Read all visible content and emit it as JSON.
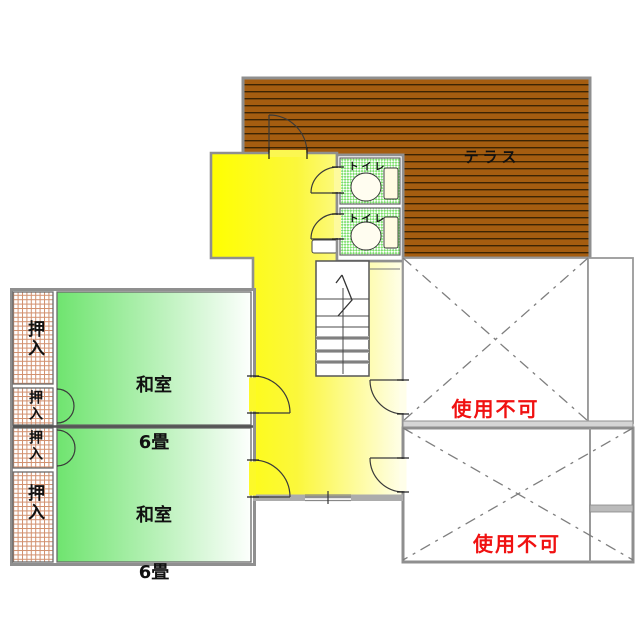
{
  "plan": {
    "terrace": {
      "label": "テラス"
    },
    "toilets": [
      {
        "label": "トイレ"
      },
      {
        "label": "トイレ"
      }
    ],
    "rooms": [
      {
        "name": "和室",
        "size": "6畳"
      },
      {
        "name": "和室",
        "size": "6畳"
      }
    ],
    "closets": [
      {
        "label": "押入"
      },
      {
        "label": "押入"
      },
      {
        "label": "押入"
      },
      {
        "label": "押入"
      }
    ],
    "unusable": [
      {
        "label": "使用不可"
      },
      {
        "label": "使用不可"
      }
    ],
    "colors": {
      "terrace_brown": "#A55D10",
      "terrace_stripe": "#3C2403",
      "hallway_yellow": "#FFFF00",
      "room_green": "#6FE46F",
      "toilet_green": "#7CDF6C",
      "closet_grid": "#D2906E",
      "unusable_red": "#F01111",
      "wall_gray": "#8F8F8F"
    }
  }
}
